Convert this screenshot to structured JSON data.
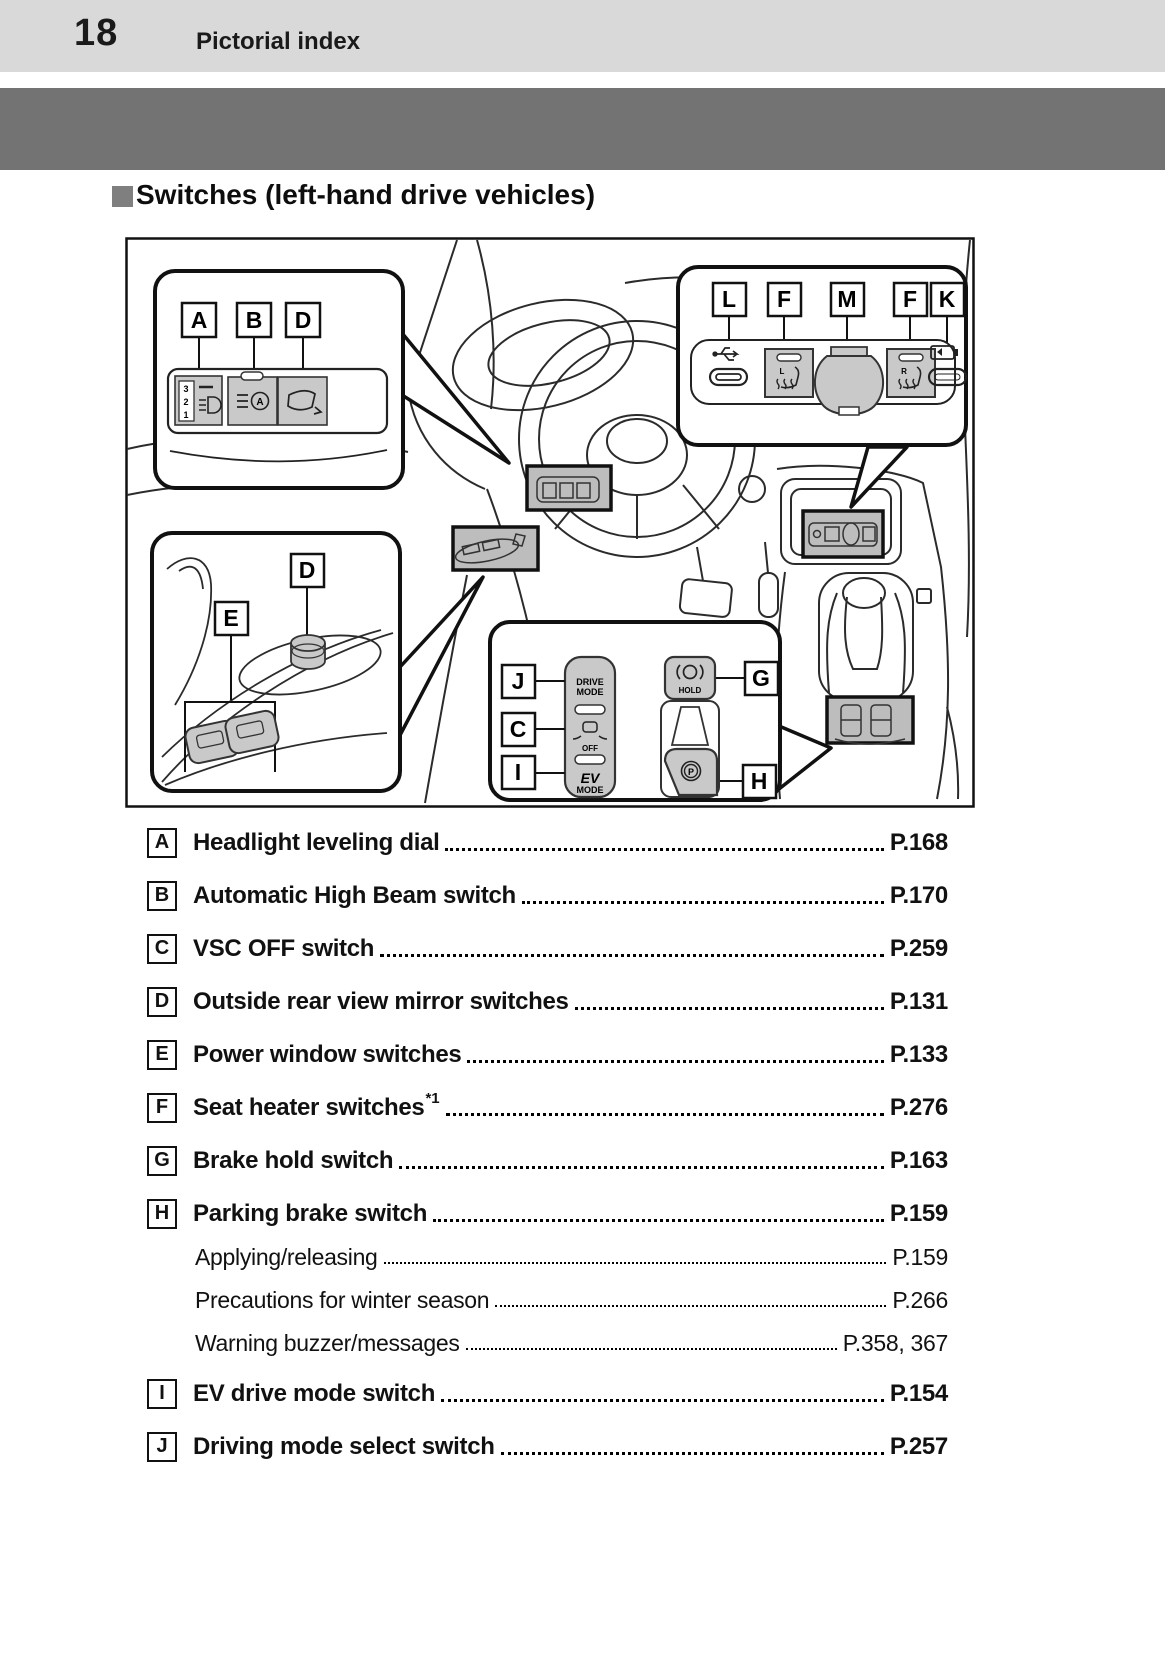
{
  "page": {
    "number": "18",
    "section": "Pictorial index"
  },
  "heading": "Switches (left-hand drive vehicles)",
  "colors": {
    "header_bar": "#d9d9d9",
    "gray_band": "#737373",
    "heading_square": "#7f7f7f",
    "switch_panel_gray": "#c9c9c9",
    "highlight_box_gray": "#bdbdbd"
  },
  "diagram": {
    "callouts": {
      "top_left": {
        "labels": [
          "A",
          "B",
          "D"
        ],
        "dial_numbers": [
          "3",
          "2",
          "1"
        ],
        "high_beam_a": "A"
      },
      "top_right": {
        "labels": [
          "L",
          "F",
          "M",
          "F",
          "K"
        ],
        "seat_heater_left": "L",
        "seat_heater_right": "R"
      },
      "door": {
        "labels": [
          "D",
          "E"
        ]
      },
      "console": {
        "left_labels": [
          "J",
          "C",
          "I"
        ],
        "right_labels": [
          "G",
          "H"
        ],
        "texts": {
          "drive": "DRIVE",
          "drive_mode": "MODE",
          "vsc_off": "OFF",
          "ev": "EV",
          "ev_mode": "MODE",
          "hold": "HOLD",
          "park": "P"
        }
      }
    }
  },
  "index": {
    "items": [
      {
        "label": "A",
        "text": "Headlight leveling dial",
        "page": "P.168"
      },
      {
        "label": "B",
        "text": "Automatic High Beam switch",
        "page": "P.170"
      },
      {
        "label": "C",
        "text": "VSC OFF switch",
        "page": "P.259"
      },
      {
        "label": "D",
        "text": "Outside rear view mirror switches",
        "page": "P.131"
      },
      {
        "label": "E",
        "text": "Power window switches",
        "page": "P.133"
      },
      {
        "label": "F",
        "text": "Seat heater switches",
        "sup": "*1",
        "page": "P.276"
      },
      {
        "label": "G",
        "text": "Brake hold switch",
        "page": "P.163"
      },
      {
        "label": "H",
        "text": "Parking brake switch",
        "page": "P.159"
      },
      {
        "label": "",
        "text": "Applying/releasing",
        "page": "P.159"
      },
      {
        "label": "",
        "text": "Precautions for winter season",
        "page": "P.266"
      },
      {
        "label": "",
        "text": "Warning buzzer/messages",
        "page": "P.358, 367"
      },
      {
        "label": "I",
        "text": "EV drive mode switch",
        "page": "P.154"
      },
      {
        "label": "J",
        "text": "Driving mode select switch",
        "page": "P.257"
      }
    ]
  }
}
